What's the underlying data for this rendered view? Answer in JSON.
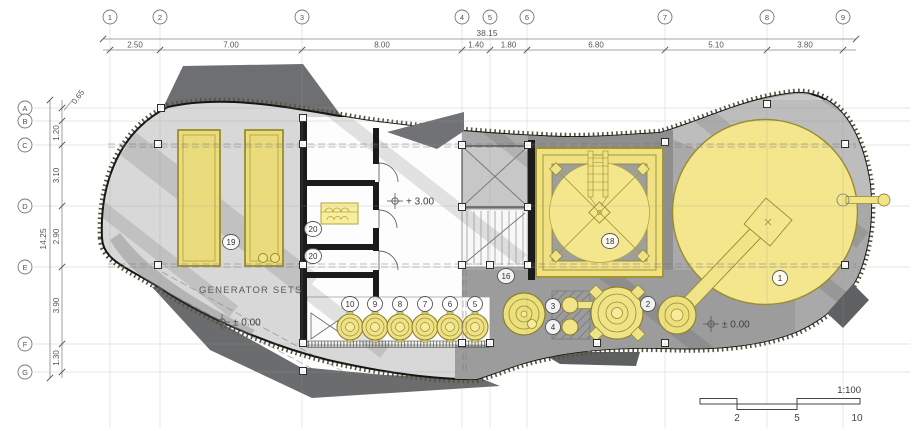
{
  "drawing_title": "plant-floor-plan",
  "scale_bar": {
    "ratio": "1:100",
    "ticks": [
      "2",
      "5",
      "10"
    ]
  },
  "texts": {
    "generator_sets": "GENERATOR SETS"
  },
  "elevation_markers": [
    {
      "text": "+ 3.00",
      "x": 395,
      "y": 201
    },
    {
      "text": "± 0.00",
      "x": 222,
      "y": 322
    },
    {
      "text": "± 0.00",
      "x": 711,
      "y": 324
    }
  ],
  "grid_top": {
    "overall": "38.15",
    "markers": [
      "1",
      "2",
      "3",
      "4",
      "5",
      "6",
      "7",
      "8",
      "9"
    ],
    "marker_x": [
      110,
      160,
      302,
      462,
      490,
      527,
      665,
      767,
      843
    ],
    "segments": [
      "2.50",
      "7.00",
      "8.00",
      "1.40",
      "1.80",
      "6.80",
      "5.10",
      "3.80"
    ]
  },
  "grid_left": {
    "overall": "14.25",
    "markers": [
      "A",
      "B",
      "C",
      "D",
      "E",
      "F",
      "G"
    ],
    "marker_y": [
      108,
      121,
      145,
      206,
      267,
      344,
      372
    ],
    "segments": [
      "0.65",
      "1.20",
      "3.10",
      "2.90",
      "3.90",
      "1.30"
    ]
  },
  "callouts": [
    {
      "n": "19",
      "x": 231,
      "y": 242
    },
    {
      "n": "20",
      "x": 313,
      "y": 229
    },
    {
      "n": "20",
      "x": 313,
      "y": 256
    },
    {
      "n": "10",
      "x": 350,
      "y": 304
    },
    {
      "n": "9",
      "x": 375,
      "y": 304
    },
    {
      "n": "8",
      "x": 400,
      "y": 304
    },
    {
      "n": "7",
      "x": 425,
      "y": 304
    },
    {
      "n": "6",
      "x": 450,
      "y": 304
    },
    {
      "n": "5",
      "x": 475,
      "y": 304
    },
    {
      "n": "16",
      "x": 506,
      "y": 276
    },
    {
      "n": "3",
      "x": 553,
      "y": 306
    },
    {
      "n": "4",
      "x": 553,
      "y": 327
    },
    {
      "n": "2",
      "x": 648,
      "y": 304
    },
    {
      "n": "18",
      "x": 610,
      "y": 241
    },
    {
      "n": "1",
      "x": 780,
      "y": 278
    }
  ],
  "colors": {
    "yellow_fill": "#f2e48a",
    "yellow_stroke": "#9a8c2e",
    "floor": "#d8d8d8",
    "deck": "#a9a9a9",
    "dark_shadow": "#6b6c6e",
    "wall": "#1b1b1b"
  }
}
